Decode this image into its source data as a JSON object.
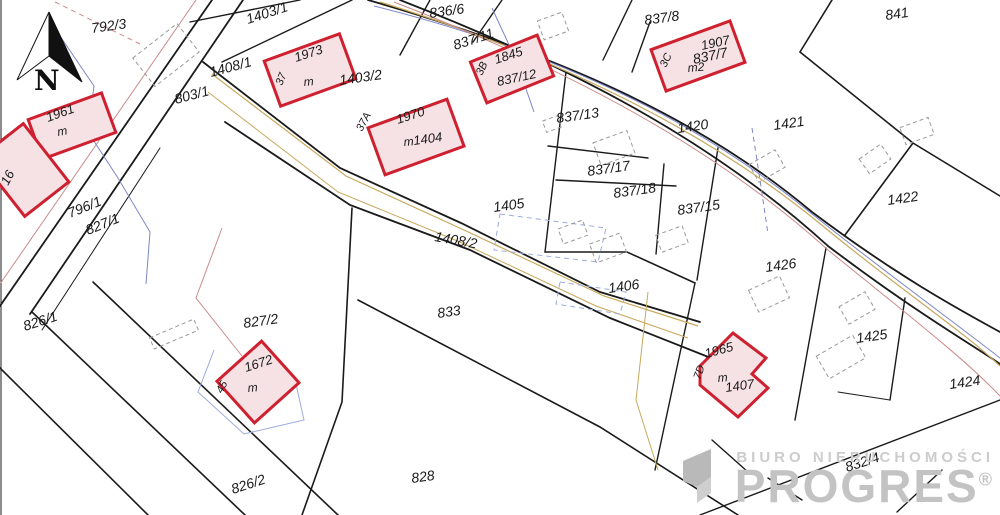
{
  "watermark": {
    "line1": "BIURO NIERUCHOMOŚCI",
    "line2": "PROGRES",
    "reg": "®"
  },
  "map": {
    "colors": {
      "boundary": "#1a1a1a",
      "building_stroke": "#cf2030",
      "building_fill": "#f6e2e4",
      "tan": "#c8a85a",
      "blue": "#7b86c8",
      "lightblue": "#9badde",
      "pink": "#cc8a8a",
      "dashed_gray": "#999999",
      "label": "#1a1a1a",
      "watermark_gray": "#c6c6c6"
    },
    "north_arrow": {
      "letter": "N",
      "white_pts": "49,12 17,80 49,56",
      "black_pts": "49,12 82,82 49,56"
    },
    "boundary_lines": [
      {
        "d": "M1,0 L1,515",
        "w": 1
      },
      {
        "d": "M212,0 L0,306",
        "w": 1.8
      },
      {
        "d": "M243,0 L30,314",
        "w": 1.8
      },
      {
        "d": "M160,148 L42,330",
        "w": 1
      },
      {
        "d": "M368,0 C560,55 700,118 812,212 C900,278 960,310 1000,332",
        "w": 1.8
      },
      {
        "d": "M400,0 C585,72 718,146 828,246 C915,312 968,342 1000,364",
        "w": 1.8
      },
      {
        "d": "M203,62 L340,168 L461,223 L600,292 L700,322",
        "w": 1.8
      },
      {
        "d": "M225,122 L350,205 L470,250 L610,318 L716,360",
        "w": 1.8
      },
      {
        "d": "M190,22 L300,0",
        "w": 1.4
      },
      {
        "d": "M222,62 L352,0",
        "w": 1.4
      },
      {
        "d": "M400,55 L430,0",
        "w": 1.4
      },
      {
        "d": "M473,42 L502,0",
        "w": 1.4
      },
      {
        "d": "M632,0 L603,60",
        "w": 1.4
      },
      {
        "d": "M650,22 L632,72",
        "w": 1.4
      },
      {
        "d": "M832,0 L800,52",
        "w": 1.6
      },
      {
        "d": "M800,52 L913,143 L1000,196",
        "w": 1.6
      },
      {
        "d": "M913,143 L845,235",
        "w": 1.6
      },
      {
        "d": "M566,72 L545,252",
        "w": 1.4
      },
      {
        "d": "M548,146 L648,158",
        "w": 1.4
      },
      {
        "d": "M556,180 L676,186",
        "w": 1.4
      },
      {
        "d": "M664,164 L656,254",
        "w": 1.4
      },
      {
        "d": "M545,252 L627,252 L695,283",
        "w": 1.6
      },
      {
        "d": "M718,148 L697,280",
        "w": 1.4
      },
      {
        "d": "M826,248 L795,420",
        "w": 1.4
      },
      {
        "d": "M905,298 L890,400",
        "w": 1.4
      },
      {
        "d": "M352,208 L342,402 L302,515",
        "w": 1.6
      },
      {
        "d": "M358,300 L600,427 L738,515",
        "w": 1.6
      },
      {
        "d": "M695,283 L655,470",
        "w": 1.4
      },
      {
        "d": "M32,312 L245,515",
        "w": 1.6
      },
      {
        "d": "M0,368 L148,515",
        "w": 1.6
      },
      {
        "d": "M93,282 L338,515",
        "w": 1.6
      },
      {
        "d": "M700,515 L1000,400",
        "w": 1.4
      },
      {
        "d": "M838,392 L890,400",
        "w": 1
      },
      {
        "d": "M712,440 L748,472",
        "w": 1.4
      },
      {
        "d": "M768,478 L802,500",
        "w": 1.4
      },
      {
        "d": "M897,512 L942,470",
        "w": 1.4
      }
    ],
    "utility_lines": [
      {
        "d": "M374,6 C558,52 700,122 812,214 C898,282 958,325 1000,358",
        "color": "blue",
        "w": 1
      },
      {
        "d": "M380,2 C560,58 705,130 818,222 C900,290 962,330 1000,366",
        "color": "tan",
        "w": 1.2
      },
      {
        "d": "M394,2 C575,72 715,148 828,250 C912,318 966,360 1000,396",
        "color": "pink",
        "w": 1
      },
      {
        "d": "M212,74 L346,176 L464,230 L604,296 L698,326",
        "color": "tan",
        "w": 1.2
      },
      {
        "d": "M208,92 L338,192 L460,242 L596,306 L688,338",
        "color": "tan",
        "w": 1
      },
      {
        "d": "M196,0 L0,284",
        "color": "pink",
        "w": 1
      },
      {
        "d": "M492,8 L516,60 L534,112",
        "color": "blue",
        "w": 1
      },
      {
        "d": "M752,128 L760,180 L768,234",
        "color": "blue",
        "w": 1,
        "dash": "5 4"
      },
      {
        "d": "M222,228 L196,298 L242,356",
        "color": "pink",
        "w": 1
      },
      {
        "d": "M214,350 L198,392 L244,434 L304,420 L296,384",
        "color": "lightblue",
        "w": 1
      },
      {
        "d": "M648,292 L636,400 L658,470",
        "color": "tan",
        "w": 1
      },
      {
        "d": "M60,36 L94,86 L88,132 L118,178 L150,232 L146,284",
        "color": "blue",
        "w": 1
      },
      {
        "d": "M55,2 L140,44",
        "color": "pink",
        "w": 1,
        "dash": "5 4"
      },
      {
        "d": "M500,214 L606,228 L598,262 L494,250 Z",
        "color": "lightblue",
        "w": 1,
        "dash": "5 4"
      },
      {
        "d": "M560,282 L626,292 L620,314 L556,304 Z",
        "color": "lightblue",
        "w": 1,
        "dash": "5 4"
      }
    ],
    "dashed_buildings": [
      {
        "x": 166,
        "y": 55,
        "w": 56,
        "h": 36,
        "rot": -38
      },
      {
        "x": 553,
        "y": 26,
        "w": 26,
        "h": 20,
        "rot": -20
      },
      {
        "x": 917,
        "y": 131,
        "w": 30,
        "h": 18,
        "rot": -20
      },
      {
        "x": 767,
        "y": 166,
        "w": 30,
        "h": 20,
        "rot": -30
      },
      {
        "x": 875,
        "y": 159,
        "w": 26,
        "h": 18,
        "rot": -35
      },
      {
        "x": 614,
        "y": 148,
        "w": 36,
        "h": 24,
        "rot": -20
      },
      {
        "x": 552,
        "y": 124,
        "w": 16,
        "h": 12,
        "rot": -20
      },
      {
        "x": 573,
        "y": 232,
        "w": 26,
        "h": 16,
        "rot": -20
      },
      {
        "x": 608,
        "y": 248,
        "w": 32,
        "h": 20,
        "rot": -20
      },
      {
        "x": 672,
        "y": 239,
        "w": 28,
        "h": 18,
        "rot": -20
      },
      {
        "x": 769,
        "y": 294,
        "w": 34,
        "h": 24,
        "rot": -25
      },
      {
        "x": 857,
        "y": 308,
        "w": 30,
        "h": 20,
        "rot": -30
      },
      {
        "x": 841,
        "y": 357,
        "w": 42,
        "h": 26,
        "rot": -30
      },
      {
        "x": 174,
        "y": 334,
        "w": 48,
        "h": 12,
        "rot": -23
      }
    ],
    "buildings": [
      {
        "id": "1961",
        "rect": {
          "cx": 72,
          "cy": 126,
          "w": 78,
          "h": 42,
          "rot": -20
        },
        "labels": [
          {
            "t": "1961",
            "x": 48,
            "y": 122,
            "rot": -20,
            "s": 13
          },
          {
            "t": "m",
            "x": 58,
            "y": 136,
            "rot": -10,
            "s": 12,
            "it": true
          }
        ]
      },
      {
        "id": "16",
        "rect": {
          "cx": 24,
          "cy": 170,
          "w": 56,
          "h": 74,
          "rot": -38
        },
        "labels": [
          {
            "t": "16",
            "x": 8,
            "y": 186,
            "rot": -62,
            "s": 13
          }
        ]
      },
      {
        "id": "1973",
        "rect": {
          "cx": 310,
          "cy": 70,
          "w": 80,
          "h": 48,
          "rot": -20
        },
        "labels": [
          {
            "t": "37",
            "x": 282,
            "y": 86,
            "rot": -68,
            "s": 11
          },
          {
            "t": "1973",
            "x": 296,
            "y": 62,
            "rot": -18,
            "s": 13
          },
          {
            "t": "m",
            "x": 304,
            "y": 86,
            "rot": -5,
            "s": 12,
            "it": true
          }
        ]
      },
      {
        "id": "1970",
        "rect": {
          "cx": 416,
          "cy": 137,
          "w": 84,
          "h": 50,
          "rot": -20
        },
        "labels": [
          {
            "t": "37A",
            "x": 362,
            "y": 132,
            "rot": -62,
            "s": 11
          },
          {
            "t": "1970",
            "x": 398,
            "y": 124,
            "rot": -18,
            "s": 13
          },
          {
            "t": "m",
            "x": 404,
            "y": 146,
            "rot": -5,
            "s": 12,
            "it": true
          },
          {
            "t": "1404",
            "x": 414,
            "y": 145,
            "rot": -8,
            "s": 13
          }
        ]
      },
      {
        "id": "1845",
        "rect": {
          "cx": 512,
          "cy": 69,
          "w": 72,
          "h": 44,
          "rot": -22
        },
        "labels": [
          {
            "t": "3B",
            "x": 482,
            "y": 76,
            "rot": -65,
            "s": 11
          },
          {
            "t": "1845",
            "x": 496,
            "y": 64,
            "rot": -18,
            "s": 13
          },
          {
            "t": "837/12",
            "x": 498,
            "y": 86,
            "rot": -12,
            "s": 13
          }
        ]
      },
      {
        "id": "1907",
        "rect": {
          "cx": 698,
          "cy": 56,
          "w": 84,
          "h": 44,
          "rot": -20
        },
        "labels": [
          {
            "t": "3C",
            "x": 666,
            "y": 68,
            "rot": -65,
            "s": 11
          },
          {
            "t": "1907",
            "x": 702,
            "y": 50,
            "rot": -12,
            "s": 13
          },
          {
            "t": "m2",
            "x": 688,
            "y": 72,
            "rot": -5,
            "s": 12,
            "it": true
          }
        ]
      },
      {
        "id": "1672",
        "rect": {
          "cx": 258,
          "cy": 382,
          "w": 60,
          "h": 56,
          "rot": -42
        },
        "labels": [
          {
            "t": "45",
            "x": 222,
            "y": 394,
            "rot": -62,
            "s": 11
          },
          {
            "t": "1672",
            "x": 246,
            "y": 372,
            "rot": -18,
            "s": 13
          },
          {
            "t": "m",
            "x": 248,
            "y": 392,
            "rot": -5,
            "s": 12,
            "it": true
          }
        ]
      },
      {
        "id": "1965",
        "poly": "700,366 733,333 766,358 752,374 768,388 738,417 700,385",
        "labels": [
          {
            "t": "7D",
            "x": 700,
            "y": 380,
            "rot": -70,
            "s": 11
          },
          {
            "t": "1965",
            "x": 706,
            "y": 358,
            "rot": -15,
            "s": 13
          },
          {
            "t": "m",
            "x": 718,
            "y": 382,
            "rot": -5,
            "s": 12,
            "it": true
          },
          {
            "t": "1407",
            "x": 726,
            "y": 392,
            "rot": -8,
            "s": 13
          }
        ]
      }
    ],
    "parcel_labels": [
      {
        "t": "792/3",
        "x": 92,
        "y": 33,
        "rot": -8
      },
      {
        "t": "1403/1",
        "x": 248,
        "y": 24,
        "rot": -18
      },
      {
        "t": "836/6",
        "x": 430,
        "y": 18,
        "rot": -8
      },
      {
        "t": "837/8",
        "x": 645,
        "y": 25,
        "rot": -8
      },
      {
        "t": "841",
        "x": 886,
        "y": 20,
        "rot": -8
      },
      {
        "t": "1408/1",
        "x": 211,
        "y": 77,
        "rot": -15
      },
      {
        "t": "837/11",
        "x": 455,
        "y": 50,
        "rot": -18
      },
      {
        "t": "837/7",
        "x": 694,
        "y": 64,
        "rot": -12
      },
      {
        "t": "1403/2",
        "x": 340,
        "y": 85,
        "rot": -8
      },
      {
        "t": "803/1",
        "x": 176,
        "y": 104,
        "rot": -15
      },
      {
        "t": "837/13",
        "x": 557,
        "y": 123,
        "rot": -8
      },
      {
        "t": "1420",
        "x": 678,
        "y": 133,
        "rot": -8
      },
      {
        "t": "1421",
        "x": 774,
        "y": 130,
        "rot": -8
      },
      {
        "t": "837/17",
        "x": 588,
        "y": 176,
        "rot": -8
      },
      {
        "t": "837/18",
        "x": 614,
        "y": 198,
        "rot": -8
      },
      {
        "t": "1422",
        "x": 888,
        "y": 205,
        "rot": -8
      },
      {
        "t": "796/1",
        "x": 70,
        "y": 218,
        "rot": -22
      },
      {
        "t": "837/15",
        "x": 678,
        "y": 215,
        "rot": -8
      },
      {
        "t": "827/1",
        "x": 88,
        "y": 235,
        "rot": -22
      },
      {
        "t": "1405",
        "x": 494,
        "y": 212,
        "rot": -8
      },
      {
        "t": "1408/2",
        "x": 434,
        "y": 241,
        "rot": 10
      },
      {
        "t": "1426",
        "x": 766,
        "y": 272,
        "rot": -8
      },
      {
        "t": "1406",
        "x": 609,
        "y": 293,
        "rot": -8
      },
      {
        "t": "833",
        "x": 438,
        "y": 318,
        "rot": -8
      },
      {
        "t": "826/1",
        "x": 25,
        "y": 331,
        "rot": -18
      },
      {
        "t": "827/2",
        "x": 244,
        "y": 328,
        "rot": -8
      },
      {
        "t": "1425",
        "x": 857,
        "y": 343,
        "rot": -8
      },
      {
        "t": "1424",
        "x": 950,
        "y": 389,
        "rot": -8
      },
      {
        "t": "826/2",
        "x": 233,
        "y": 494,
        "rot": -18
      },
      {
        "t": "828",
        "x": 412,
        "y": 483,
        "rot": -8
      },
      {
        "t": "832/4",
        "x": 847,
        "y": 472,
        "rot": -18
      }
    ]
  }
}
